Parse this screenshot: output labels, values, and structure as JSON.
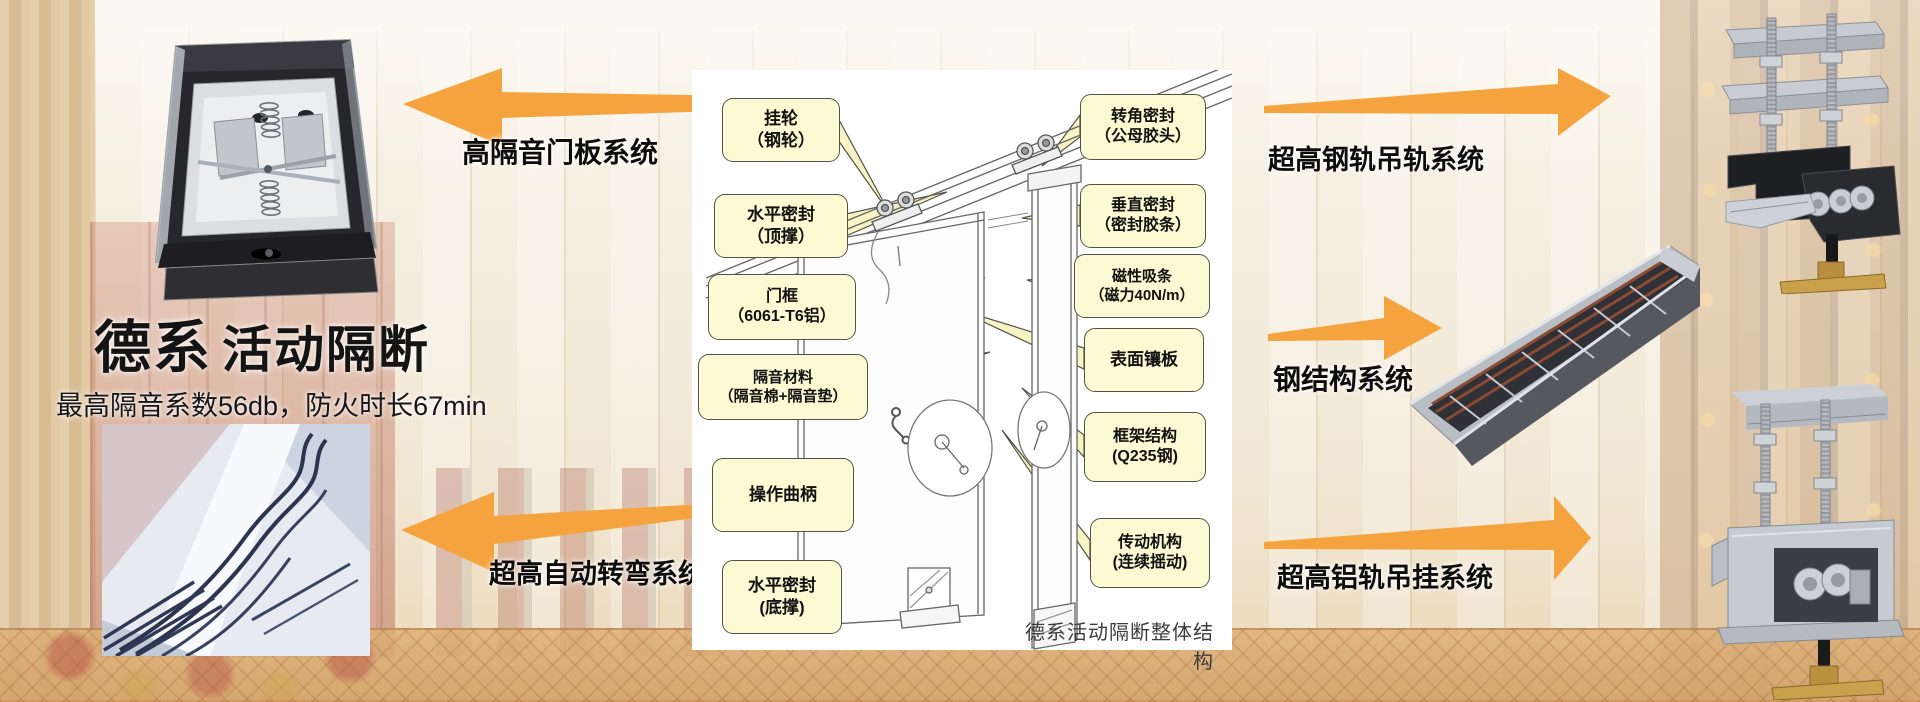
{
  "colors": {
    "accent_orange": "#F5A33E",
    "callout_bg": "#FBFAD2",
    "callout_border": "#55524A",
    "background_cream": "#F2EAD9"
  },
  "hero": {
    "title_primary": "德系",
    "title_secondary": "活动隔断",
    "subtitle": "最高隔音系数56db，防火时长67min"
  },
  "system_labels": {
    "door_panel": "高隔音门板系统",
    "auto_turn": "超高自动转弯系统",
    "steel_rail": "超高钢轨吊轨系统",
    "steel_structure": "钢结构系统",
    "alu_rail": "超高铝轨吊挂系统"
  },
  "diagram": {
    "caption": "德系活动隔断整体结构",
    "left_callouts": [
      {
        "line1": "挂轮",
        "line2": "（钢轮）"
      },
      {
        "line1": "水平密封",
        "line2": "（顶撑）"
      },
      {
        "line1": "门框",
        "line2": "（6061-T6铝）"
      },
      {
        "line1": "隔音材料",
        "line2": "（隔音棉+隔音垫）"
      },
      {
        "line1": "操作曲柄",
        "line2": ""
      },
      {
        "line1": "水平密封",
        "line2": "(底撑)"
      }
    ],
    "right_callouts": [
      {
        "line1": "转角密封",
        "line2": "（公母胶头）"
      },
      {
        "line1": "垂直密封",
        "line2": "（密封胶条）"
      },
      {
        "line1": "磁性吸条",
        "line2": "（磁力40N/m）"
      },
      {
        "line1": "表面镶板",
        "line2": ""
      },
      {
        "line1": "框架结构",
        "line2": "(Q235钢)"
      },
      {
        "line1": "传动机构",
        "line2": "(连续摇动)"
      }
    ]
  }
}
